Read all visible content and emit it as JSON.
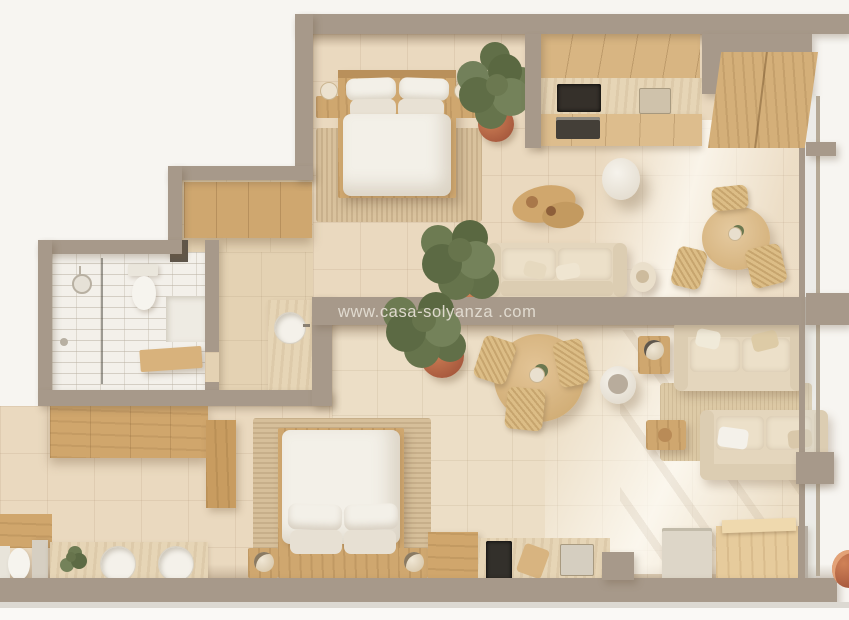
{
  "watermark": {
    "text": "www.casa-solyanza .com"
  },
  "palette": {
    "background": "#f7f5f1",
    "wall_taupe": "#a7998a",
    "floor_tile_warm": "#ead9bf",
    "floor_tile_light": "#ecdec6",
    "wood": "#cfa76f",
    "wood_light": "#dcbc8c",
    "travertine": "#e6d5b6",
    "white_fabric": "#f3f0e8",
    "sofa_beige": "#e4d6bd",
    "terracotta_pot": "#bf6e4e",
    "plant_green": "#67744c",
    "bath_tile_white": "#f3f0ea",
    "cooktop_black": "#35302a"
  },
  "scene": {
    "type": "3d-top-down-floor-plan-render",
    "units": [
      {
        "name": "upper-apartment",
        "rooms": [
          {
            "name": "bedroom",
            "furniture": [
              "double-bed",
              "pillows",
              "duvet",
              "nightstand-left",
              "nightstand-right",
              "table-lamps",
              "woven-area-rug",
              "potted-olive-tree"
            ]
          },
          {
            "name": "kitchen",
            "furniture": [
              "upper-cabinets",
              "travertine-backsplash",
              "cooktop",
              "oven",
              "sink",
              "tall-wardrobe",
              "pedestal-side-table"
            ]
          },
          {
            "name": "living-dining",
            "furniture": [
              "sofa",
              "throw-pillows",
              "organic-coffee-table",
              "drum-lamp-table",
              "round-dining-table",
              "rattan-chairs",
              "potted-plant"
            ]
          },
          {
            "name": "bathroom",
            "furniture": [
              "walk-in-shower",
              "glass-screen",
              "toilet",
              "wood-bench",
              "round-basin-vanity"
            ]
          },
          {
            "name": "entry-hall",
            "furniture": [
              "wardrobe"
            ]
          }
        ]
      },
      {
        "name": "lower-apartment",
        "rooms": [
          {
            "name": "living-dining",
            "furniture": [
              "round-dining-table",
              "rattan-chairs",
              "potted-olive-tree",
              "sofa-north",
              "sofa-south",
              "jute-rug",
              "coffee-table",
              "drum-side-table",
              "vase-side-table"
            ]
          },
          {
            "name": "kitchen",
            "furniture": [
              "base-cabinet",
              "cooktop",
              "counter",
              "sink",
              "fridge",
              "wood-island",
              "terracotta-pot"
            ]
          },
          {
            "name": "bedroom",
            "furniture": [
              "double-bed",
              "pillows",
              "duvet",
              "nightstand-left",
              "nightstand-right",
              "sphere-lamps",
              "woven-rug",
              "desk-cabinet"
            ]
          },
          {
            "name": "bathroom",
            "furniture": [
              "double-basin-vanity",
              "toilet",
              "small-plant",
              "wardrobe",
              "tall-cabinet"
            ]
          }
        ]
      }
    ]
  }
}
